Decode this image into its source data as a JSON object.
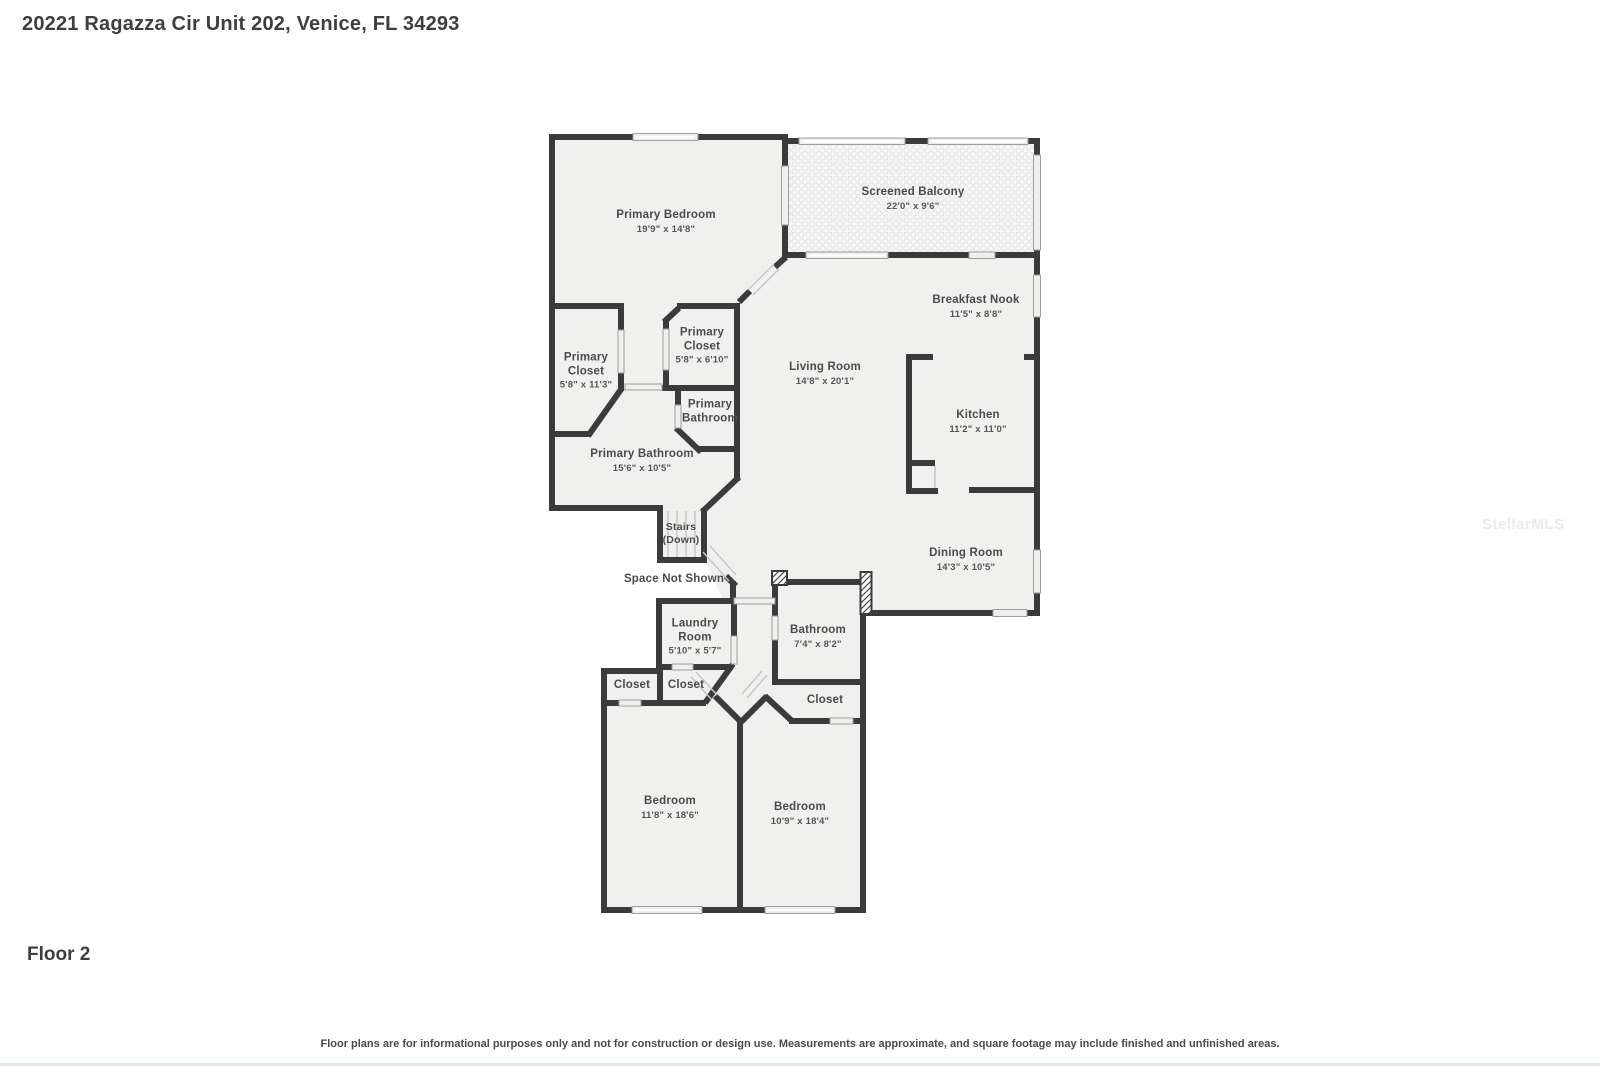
{
  "header": {
    "title": "20221 Ragazza Cir Unit 202, Venice, FL 34293"
  },
  "floor_label": "Floor 2",
  "watermark": "StellarMLS",
  "disclaimer": "Floor plans are for informational purposes only and not for construction or design use. Measurements are approximate, and square footage may include finished and unfinished areas.",
  "colors": {
    "wall": "#3b3b3b",
    "floor": "#f0f0ef",
    "accent_strip": "#dde8f2"
  },
  "rooms": [
    {
      "id": "primary-bedroom",
      "name": "Primary Bedroom",
      "sub": "19'9\" x 14'8\""
    },
    {
      "id": "screened-balcony",
      "name": "Screened Balcony",
      "sub": "22'0\" x 9'6\""
    },
    {
      "id": "breakfast-nook",
      "name": "Breakfast Nook",
      "sub": "11'5\" x 8'8\""
    },
    {
      "id": "living-room",
      "name": "Living Room",
      "sub": "14'8\" x 20'1\""
    },
    {
      "id": "kitchen",
      "name": "Kitchen",
      "sub": "11'2\" x 11'0\""
    },
    {
      "id": "dining-room",
      "name": "Dining Room",
      "sub": "14'3\" x 10'5\""
    },
    {
      "id": "primary-closet-small",
      "name": "Primary Closet",
      "sub": "5'8\" x 6'10\""
    },
    {
      "id": "primary-closet-large",
      "name": "Primary Closet",
      "sub": "5'8\" x 11'3\""
    },
    {
      "id": "primary-bathroom-small",
      "name": "Primary Bathroom",
      "sub": ""
    },
    {
      "id": "primary-bathroom-large",
      "name": "Primary Bathroom",
      "sub": "15'6\" x 10'5\""
    },
    {
      "id": "stairs",
      "name": "Stairs",
      "sub": "(Down)"
    },
    {
      "id": "space-not-shown",
      "name": "Space Not Shown",
      "sub": ""
    },
    {
      "id": "laundry-room",
      "name": "Laundry Room",
      "sub": "5'10\" x 5'7\""
    },
    {
      "id": "bathroom",
      "name": "Bathroom",
      "sub": "7'4\" x 8'2\""
    },
    {
      "id": "closet-a",
      "name": "Closet",
      "sub": ""
    },
    {
      "id": "closet-b",
      "name": "Closet",
      "sub": ""
    },
    {
      "id": "closet-c",
      "name": "Closet",
      "sub": ""
    },
    {
      "id": "bedroom-left",
      "name": "Bedroom",
      "sub": "11'8\" x 18'6\""
    },
    {
      "id": "bedroom-right",
      "name": "Bedroom",
      "sub": "10'9\" x 18'4\""
    }
  ]
}
